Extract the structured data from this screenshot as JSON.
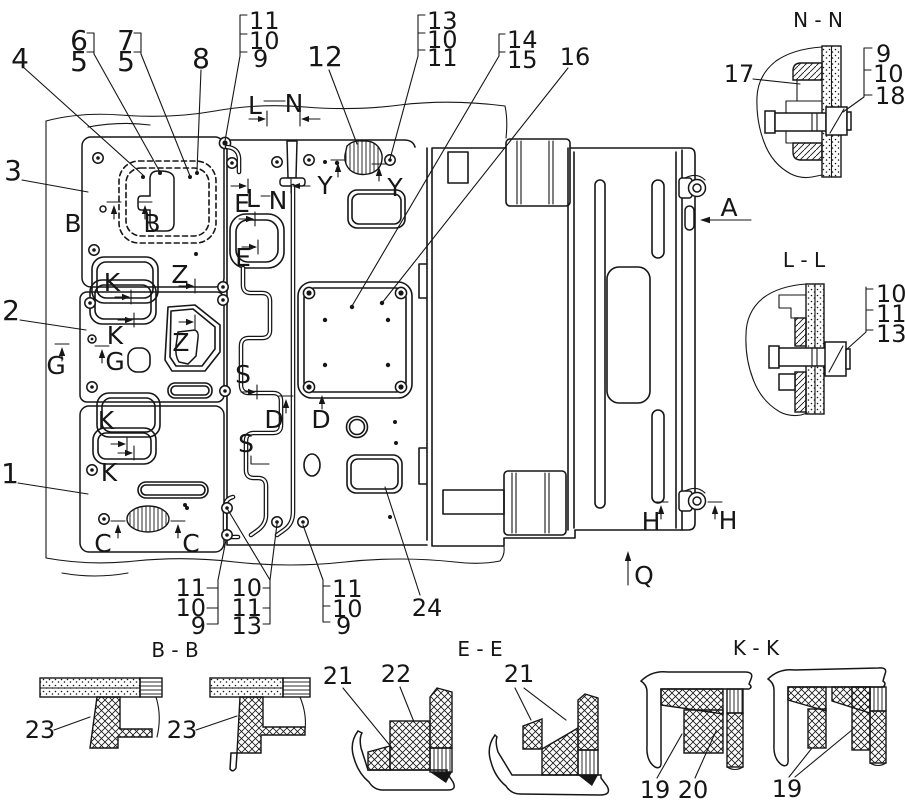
{
  "figure": {
    "background_color": "#ffffff",
    "line_color": "#161616",
    "callouts": {
      "1": "1",
      "2": "2",
      "3": "3",
      "4": "4",
      "5": "5",
      "6": "6",
      "7": "7",
      "8": "8",
      "9": "9",
      "10": "10",
      "11": "11",
      "12": "12",
      "13": "13",
      "14": "14",
      "15": "15",
      "16": "16",
      "17": "17",
      "18": "18",
      "19": "19",
      "20": "20",
      "21": "21",
      "22": "22",
      "23": "23",
      "24": "24"
    },
    "markers": {
      "A": "A",
      "B": "B",
      "C": "C",
      "D": "D",
      "E": "E",
      "G": "G",
      "H": "H",
      "K": "K",
      "L": "L",
      "N": "N",
      "Q": "Q",
      "S": "S",
      "Y": "Y",
      "Z": "Z"
    },
    "section_titles": {
      "nn": "N - N",
      "ll": "L - L",
      "bb": "B - B",
      "ee": "E - E",
      "kk": "K - K"
    }
  }
}
